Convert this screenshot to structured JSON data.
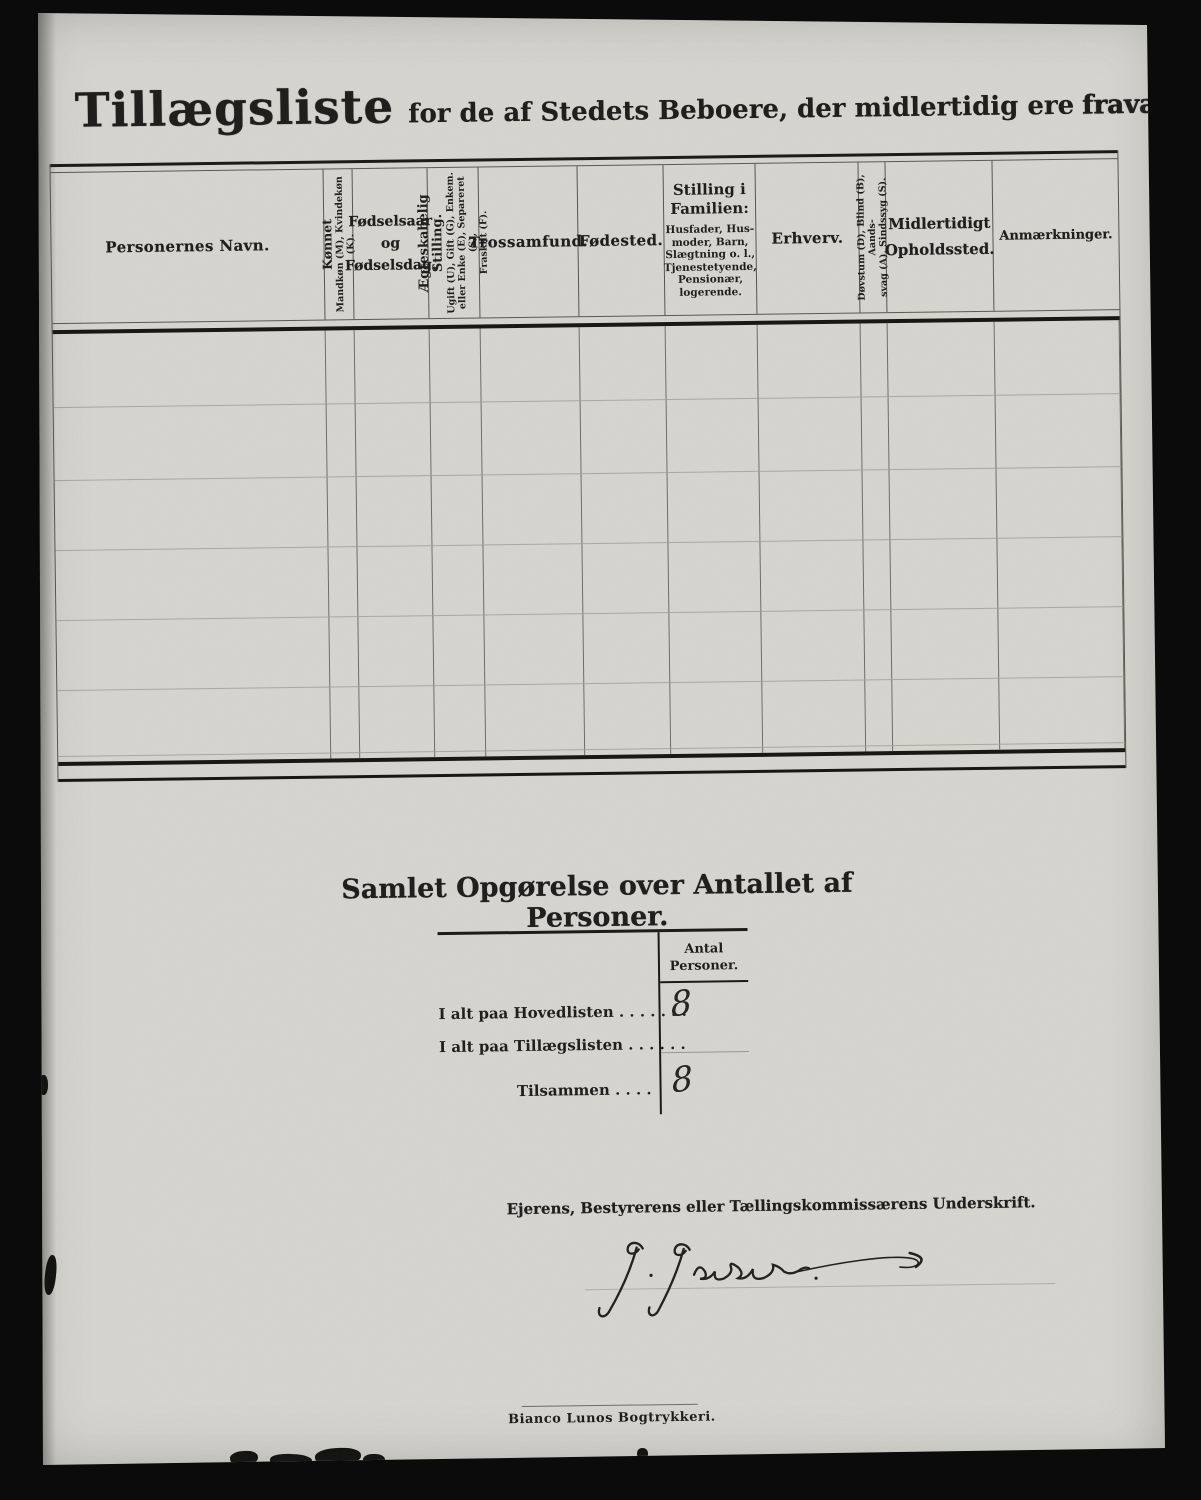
{
  "colors": {
    "background": "#0b0b0b",
    "paper": "#d8d7d2",
    "ink": "#1d1c1a",
    "faint_line": "#a3a198"
  },
  "header": {
    "title_main": "Tillægsliste",
    "title_mid": "for de af Stedets Beboere, der midlertidig ere",
    "title_end": "fraværende."
  },
  "table": {
    "columns": [
      {
        "label": "Personernes Navn."
      },
      {
        "main": "Kønnet",
        "sub": "Mandkøn (M), Kvindekøn (K)."
      },
      {
        "lines": [
          "Fødselsaar",
          "og",
          "Fødselsdag."
        ]
      },
      {
        "main": "Ægteskabelig Stilling.",
        "subs": [
          "Ugift (U), Gift (G), Enkem.",
          "eller Enke (E), Separeret (S),",
          "Fraskilt (F)."
        ]
      },
      {
        "label": "Trossamfund."
      },
      {
        "label": "Fødested."
      },
      {
        "main_lines": [
          "Stilling i",
          "Familien:"
        ],
        "subs": [
          "Husfader, Hus-",
          "moder, Barn,",
          "Slægtning o. l.,",
          "Tjenestetyende,",
          "Pensionær,",
          "logerende."
        ]
      },
      {
        "label": "Erhverv."
      },
      {
        "subs": [
          "Døvstum (D), Blind (B), Aands-",
          "svag (A), Sindssyg (S)."
        ]
      },
      {
        "lines": [
          "Midlertidigt",
          "Opholdssted."
        ]
      },
      {
        "label": "Anmærkninger."
      }
    ],
    "rows": []
  },
  "summary": {
    "title": "Samlet Opgørelse over Antallet af Personer.",
    "col_header": [
      "Antal",
      "Personer."
    ],
    "rows": [
      {
        "label": "I alt paa Hovedlisten . . . . . . .",
        "value": "8"
      },
      {
        "label": "I alt paa Tillægslisten  . . . . . .",
        "value": ""
      },
      {
        "label": "Tilsammen . . . .",
        "value": "8"
      }
    ]
  },
  "signature": {
    "label": "Ejerens, Bestyrerens eller Tællingskommissærens Underskrift.",
    "name": "J. Jacobsen"
  },
  "footer": {
    "printer": "Bianco Lunos Bogtrykkeri."
  }
}
